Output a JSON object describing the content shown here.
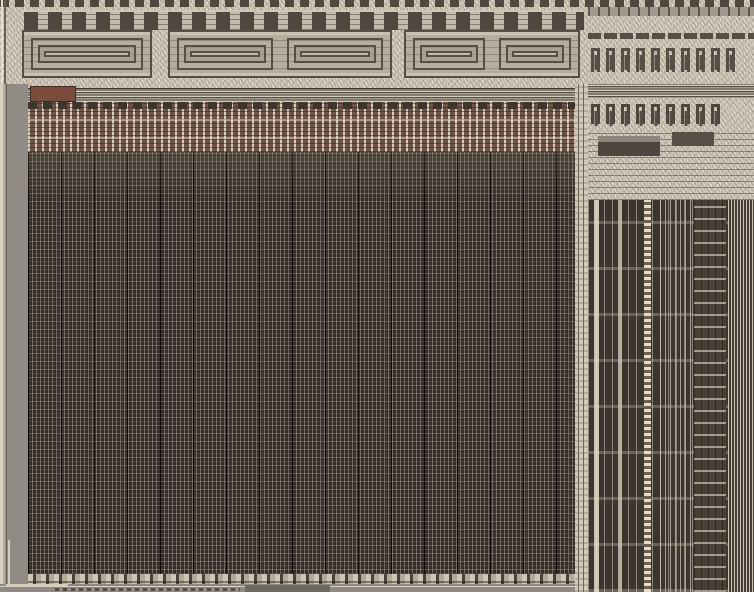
{
  "palette": {
    "beige": "#d7cec0",
    "gray_metal": "#a09a8f",
    "gray_flat": "#908c85",
    "dark_trace": "#564f45",
    "dark_line": "#3a342c",
    "cell_dark": "#4f4840",
    "logic_bg": "#b5ad9f",
    "logic_light": "#c9c1b2",
    "red_block": "#7b4b3c",
    "driver_red": "#6f5348",
    "array_base": "#332e29",
    "array_sep": "#0f0c09",
    "right_dark": "#3b352f",
    "right_line": "#cfc5b2",
    "right_bright": "#e6ddc9",
    "bottom_gray": "#8e8a83",
    "edge_light": "#d6cdbd",
    "dark_block": "#6e6a62"
  },
  "patterns": {
    "array": {
      "fine_pitch_px": 4,
      "column_pitch_px": 33
    },
    "driver_row": {
      "column_pitch_px": 7
    },
    "right_field_bands_pitch_px": 46,
    "top_hooks": {
      "count": 10
    },
    "mid_hooks": {
      "count": 9
    },
    "logic_blocks": [
      {
        "cells": 1
      },
      {
        "cells": 2
      },
      {
        "cells": 2
      }
    ]
  }
}
